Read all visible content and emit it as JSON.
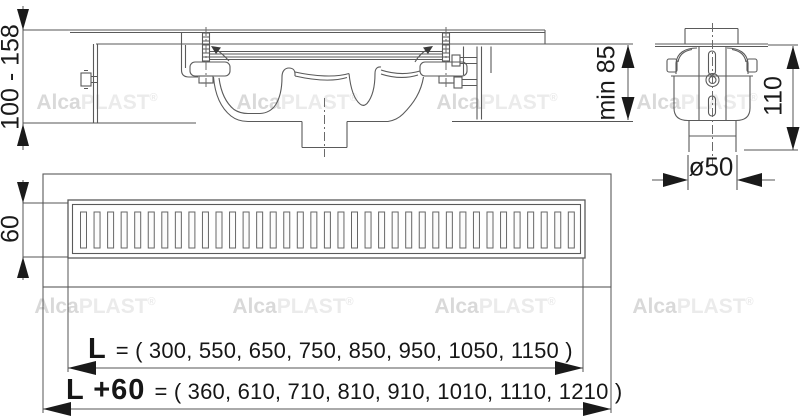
{
  "brand": {
    "watermark_part1": "Alca",
    "watermark_part2": "PLAST",
    "watermark_reg": "®"
  },
  "watermarks": {
    "positions": [
      {
        "x": 97,
        "y": 103
      },
      {
        "x": 297,
        "y": 103
      },
      {
        "x": 497,
        "y": 103
      },
      {
        "x": 697,
        "y": 103
      },
      {
        "x": 95,
        "y": 307
      },
      {
        "x": 293,
        "y": 307
      },
      {
        "x": 495,
        "y": 307
      },
      {
        "x": 693,
        "y": 307
      }
    ]
  },
  "views": {
    "section": {
      "height_range_label": "100 - 158",
      "min_depth_label": "min 85"
    },
    "side": {
      "height_label": "110",
      "pipe_diameter_label": "ø50"
    },
    "top": {
      "width_label": "60",
      "grate_slot_count": 37
    }
  },
  "dimensions": {
    "length": {
      "symbol": "L",
      "values": "= ( 300, 550, 650, 750, 850, 950, 1050, 1150 )"
    },
    "length_plus": {
      "symbol": "L +60",
      "values": "= ( 360, 610, 710, 810, 910, 1010, 1110, 1210 )"
    }
  },
  "colors": {
    "line": "#5a5a5a",
    "dim": "#1a1a1a",
    "watermark": "#e2e2e2"
  }
}
